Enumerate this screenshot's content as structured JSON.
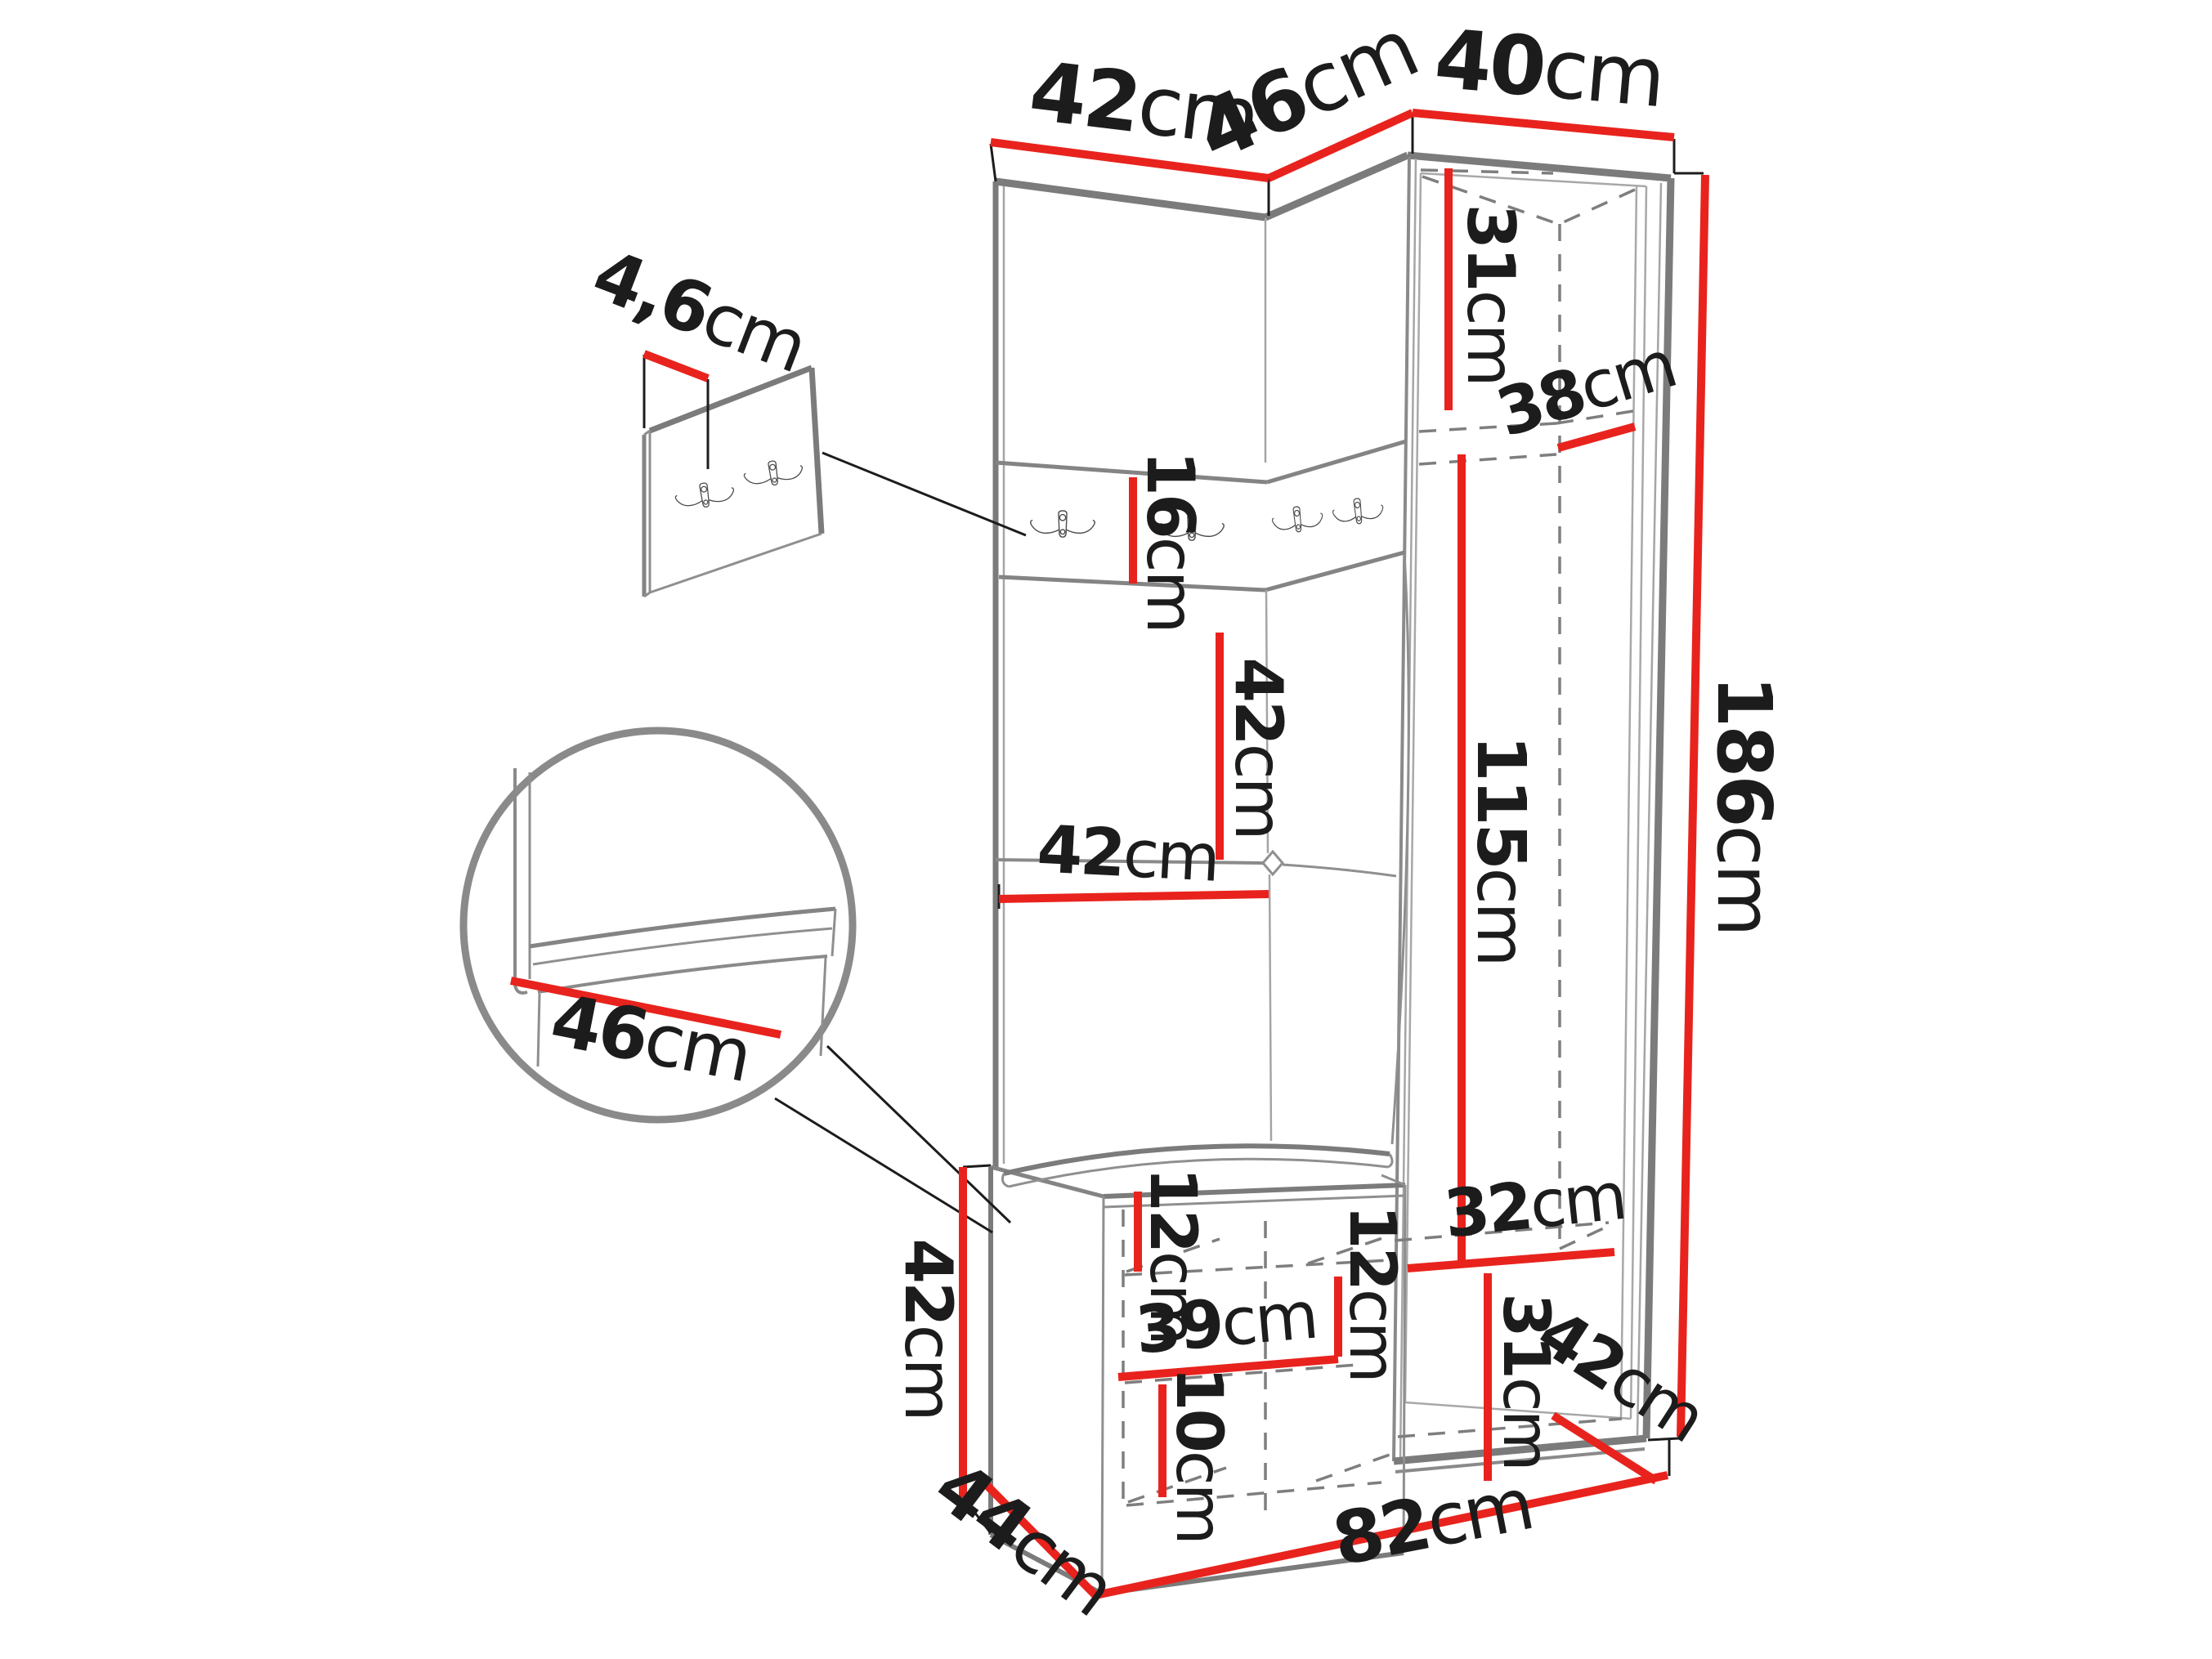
{
  "figure": {
    "type": "furniture-dimension-diagram",
    "subject": "hallway corner wardrobe with coat hooks, mirror section and shoe bench",
    "unit": "cm",
    "background": "#ffffff"
  },
  "colors": {
    "dimension_line": "#e8231d",
    "outline": "#7b7b7b",
    "outline_light": "#a8a8a8",
    "leader_line": "#1c1c1c",
    "text": "#1c1c1c"
  },
  "dimensions": {
    "top_width_left": {
      "value": "42",
      "unit": "cm"
    },
    "top_width_middle": {
      "value": "46",
      "unit": "cm"
    },
    "top_width_right": {
      "value": "40",
      "unit": "cm"
    },
    "hook_panel_thickness": {
      "value": "4,6",
      "unit": "cm"
    },
    "upper_compartment_height": {
      "value": "31",
      "unit": "cm"
    },
    "upper_compartment_depth": {
      "value": "38",
      "unit": "cm"
    },
    "hook_rail_height": {
      "value": "16",
      "unit": "cm"
    },
    "back_panel_height": {
      "value": "42",
      "unit": "cm"
    },
    "back_panel_width": {
      "value": "42",
      "unit": "cm"
    },
    "mirror_door_height": {
      "value": "115",
      "unit": "cm"
    },
    "total_height": {
      "value": "186",
      "unit": "cm"
    },
    "seat_width": {
      "value": "46",
      "unit": "cm"
    },
    "bench_height": {
      "value": "42",
      "unit": "cm"
    },
    "bench_upper_gap": {
      "value": "12",
      "unit": "cm"
    },
    "bench_middle_gap": {
      "value": "12",
      "unit": "cm"
    },
    "bench_shelf_width": {
      "value": "39",
      "unit": "cm"
    },
    "bench_lower_gap": {
      "value": "10",
      "unit": "cm"
    },
    "lower_shelf_width": {
      "value": "32",
      "unit": "cm"
    },
    "lower_compartment_height": {
      "value": "31",
      "unit": "cm"
    },
    "lower_compartment_depth": {
      "value": "42",
      "unit": "cm"
    },
    "bench_depth": {
      "value": "44",
      "unit": "cm"
    },
    "base_width": {
      "value": "82",
      "unit": "cm"
    }
  }
}
